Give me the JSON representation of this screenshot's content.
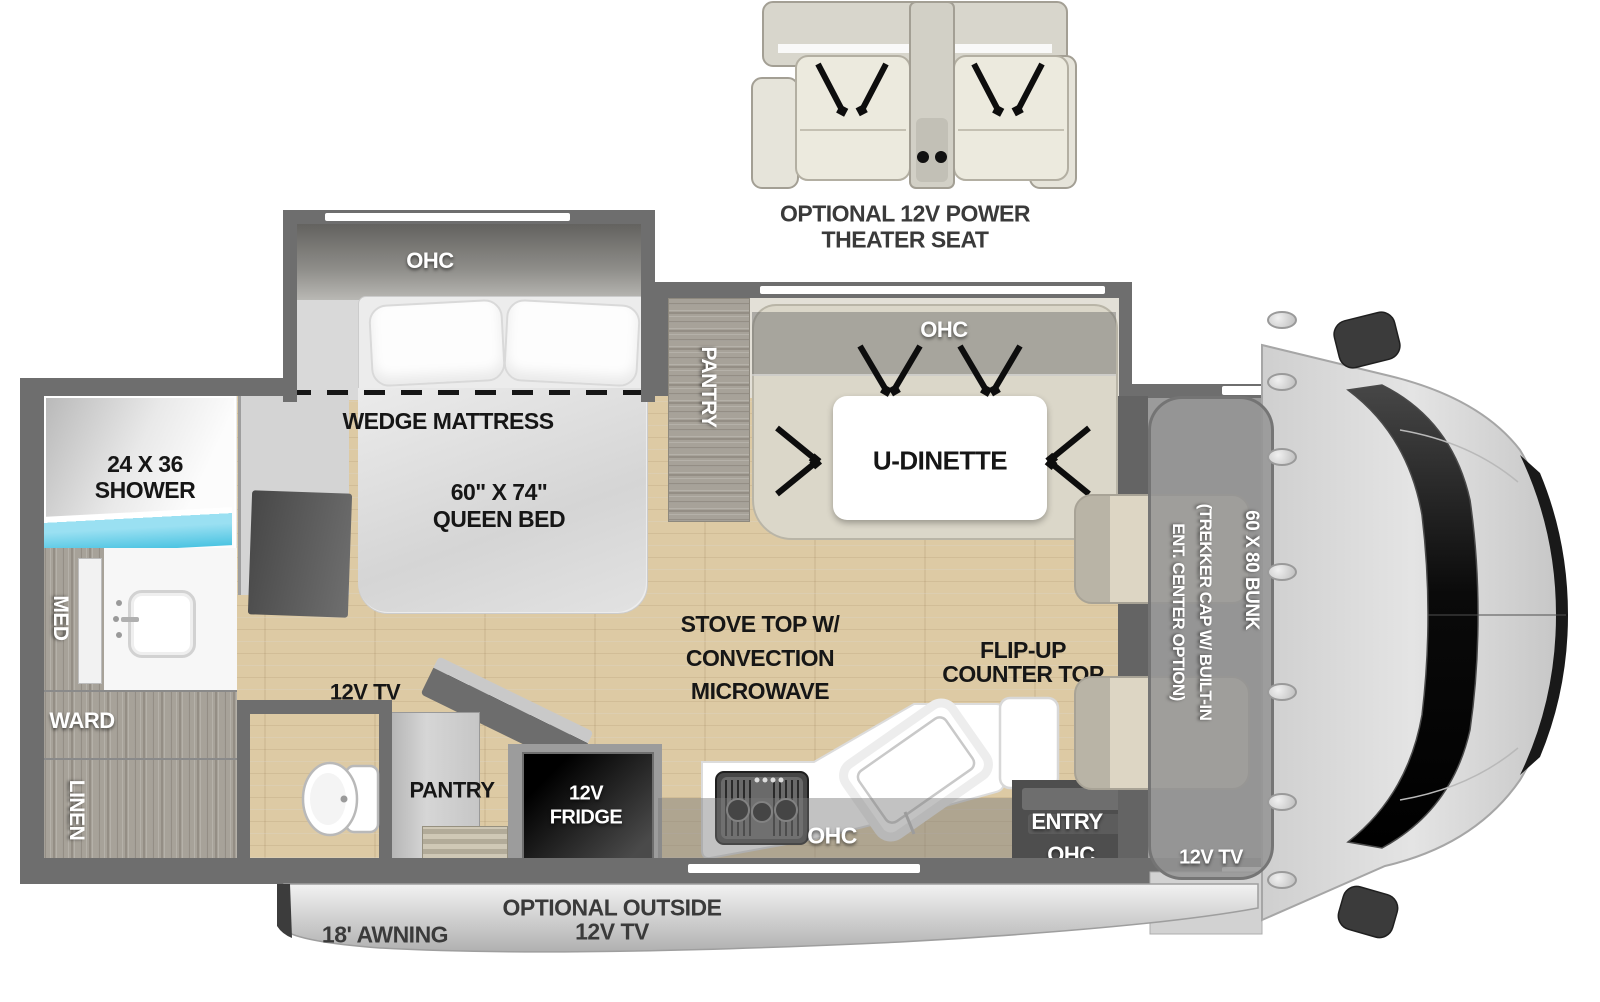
{
  "colors": {
    "wall": "#6e6e6e",
    "floor_wood": "#ddcaa4",
    "shower_blue": "#4cc4e2",
    "cabinet_wood": "#a7a299",
    "awning_silver": "#c9c9c9",
    "label_black": "#161616",
    "label_white": "#ffffff"
  },
  "theater_seat": {
    "caption_line1": "OPTIONAL 12V POWER",
    "caption_line2": "THEATER SEAT"
  },
  "bedroom": {
    "ohc": "OHC",
    "wedge_mattress": "WEDGE MATTRESS",
    "bed_size": "60\" X 74\"",
    "bed_type": "QUEEN BED",
    "tv": "12V TV"
  },
  "bathroom": {
    "shower_size": "24 X 36",
    "shower": "SHOWER",
    "med": "MED",
    "ward": "WARD",
    "linen": "LINEN"
  },
  "dinette": {
    "pantry": "PANTRY",
    "ohc": "OHC",
    "label": "U-DINETTE"
  },
  "kitchen": {
    "pantry": "PANTRY",
    "fridge_line1": "12V",
    "fridge_line2": "FRIDGE",
    "stove_line1": "STOVE TOP W/",
    "stove_line2": "CONVECTION",
    "stove_line3": "MICROWAVE",
    "ohc": "OHC",
    "flip_line1": "FLIP-UP",
    "flip_line2": "COUNTER TOP"
  },
  "entry": {
    "label": "ENTRY",
    "ohc": "OHC"
  },
  "front_cap": {
    "trekker_line1": "(TREKKER CAP W/ BUILT-IN",
    "trekker_line2": "ENT. CENTER OPTION)",
    "bunk": "60 X 80 BUNK",
    "tv": "12V TV"
  },
  "exterior": {
    "awning": "18' AWNING",
    "outside_tv_line1": "OPTIONAL OUTSIDE",
    "outside_tv_line2": "12V TV"
  }
}
